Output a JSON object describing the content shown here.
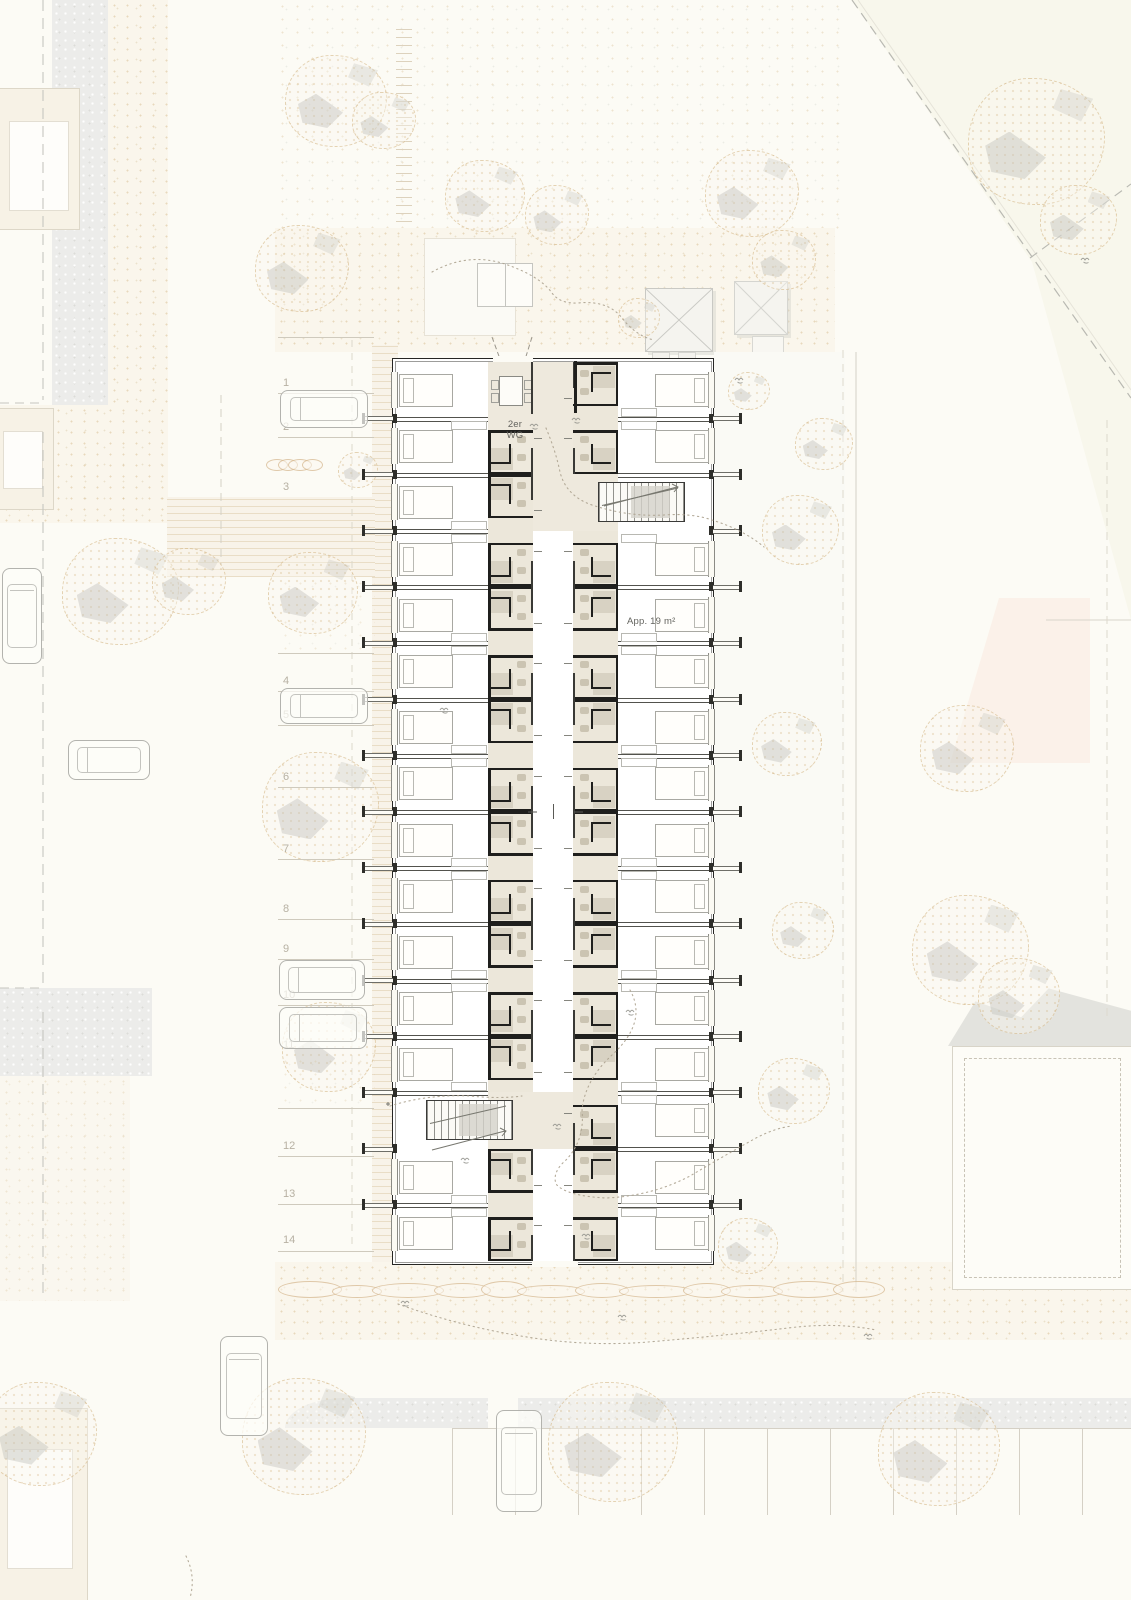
{
  "plan_labels": {
    "shared_flat_line1": "2er",
    "shared_flat_line2": "WG",
    "apartment_area": "App. 19 m²"
  },
  "parking": {
    "spaces": [
      {
        "label": "1"
      },
      {
        "label": "2"
      },
      {
        "label": "3"
      },
      {
        "label": "4"
      },
      {
        "label": "5"
      },
      {
        "label": "6"
      },
      {
        "label": "7"
      },
      {
        "label": "8"
      },
      {
        "label": "9"
      },
      {
        "label": "10"
      },
      {
        "label": "11"
      },
      {
        "label": "12"
      },
      {
        "label": "13"
      },
      {
        "label": "14"
      }
    ]
  },
  "building": {
    "rows_left": [
      "wg",
      "bB",
      "bT",
      "bB",
      "bT",
      "bB",
      "bT",
      "bB",
      "bT",
      "bB",
      "bT",
      "bB",
      "bT",
      "stair",
      "bT",
      "bB"
    ],
    "rows_right": [
      "bT",
      "bB",
      "stair",
      "bB",
      "bT",
      "bB",
      "bT",
      "bB",
      "bT",
      "bB",
      "bT",
      "bB",
      "bT",
      "bB",
      "bT",
      "bB"
    ]
  },
  "colors": {
    "paper": "#fcfbf5",
    "wall": "#262624",
    "service_band": "#ece7da",
    "bath_fill": "#d8d2c3",
    "stipple": "#ceae78",
    "road_gray": "#ececea",
    "label_text": "#63635e",
    "parking_number": "#b7b1a3"
  }
}
